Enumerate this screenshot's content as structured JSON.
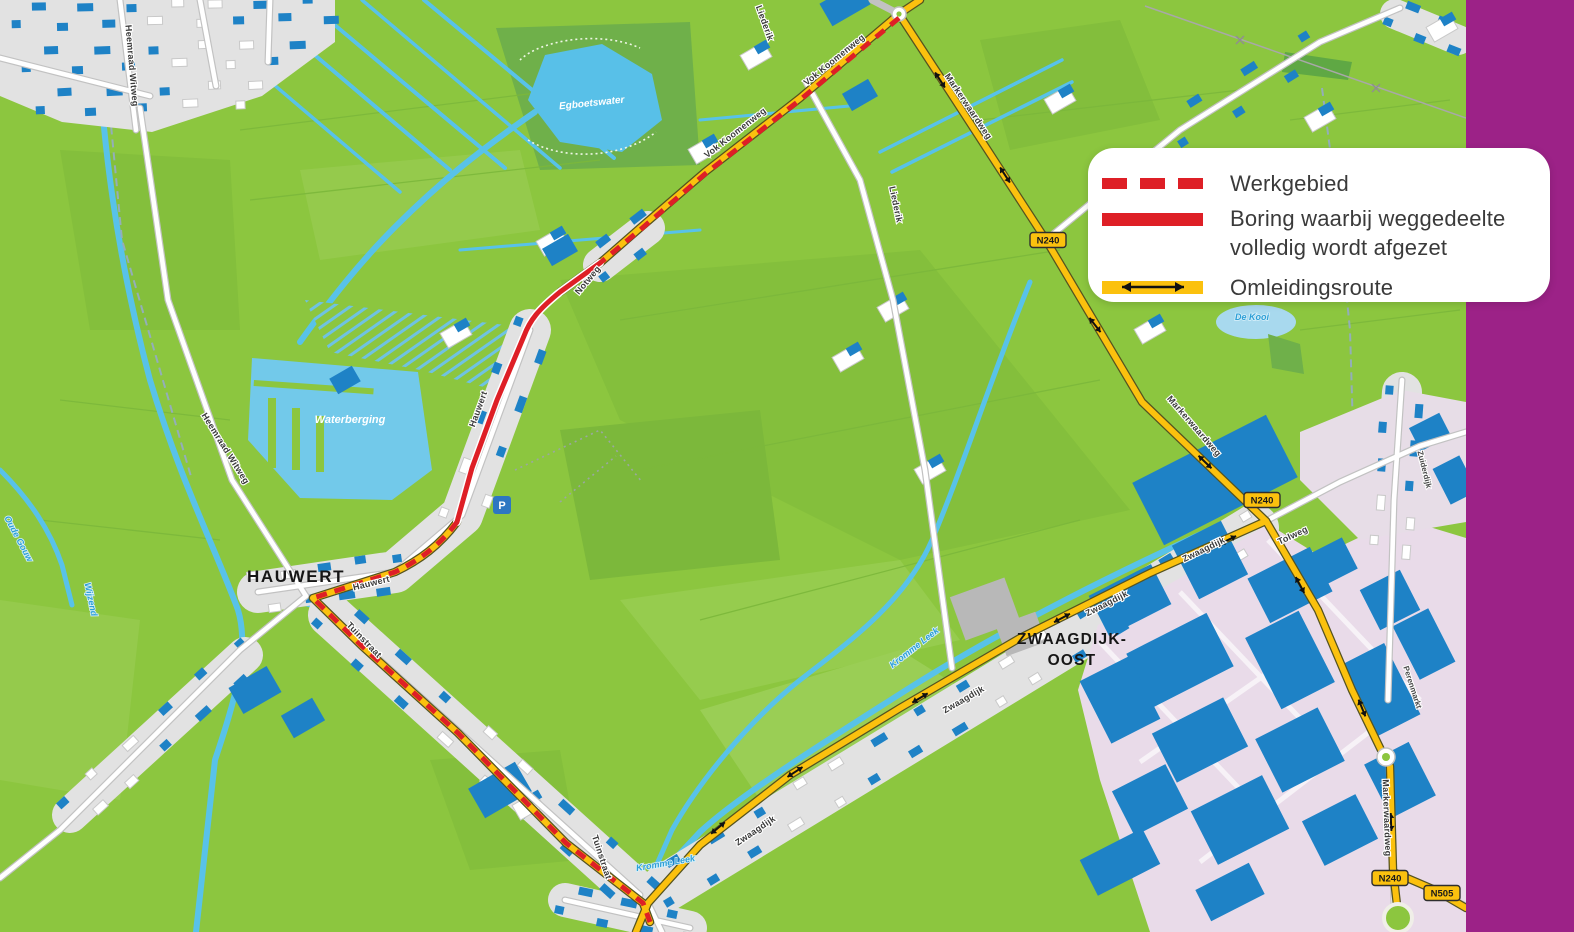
{
  "legend": {
    "items": [
      {
        "id": "werkgebied",
        "swatch": "red-dashed",
        "label": "Werkgebied"
      },
      {
        "id": "boring",
        "swatch": "red-solid",
        "label": "Boring waarbij weggedeelte volledig wordt afgezet",
        "label_line1": "Boring waarbij weggedeelte",
        "label_line2": "volledig wordt afgezet"
      },
      {
        "id": "omleidingsroute",
        "swatch": "yellow-arrow",
        "label": "Omleidingsroute"
      }
    ]
  },
  "places": {
    "hauwert": "HAUWERT",
    "zwaagdijk_oost_line1": "ZWAAGDIJK-",
    "zwaagdijk_oost_line2": "OOST"
  },
  "badges": {
    "n240": "N240",
    "n505": "N505"
  },
  "roads": {
    "vok_koomenweg": "Vok Koomenweg",
    "notweg": "Notweg",
    "hauwert_street": "Hauwert",
    "tuinstraat": "Tuinstraat",
    "zwaagdijk": "Zwaagdijk",
    "markerwaardweg": "Markerwaardweg",
    "liederik": "Liederik",
    "heemraad_witweg": "Heemraad Witweg",
    "tolweg": "Tolweg",
    "zuiderdijk": "Zuiderdijk",
    "perenmarkt": "Perenmarkt"
  },
  "water": {
    "kromme_leek": "Kromme Leek",
    "oude_gouw": "Oude Gouw",
    "wijzend": "Wijzend",
    "egboetswater": "Egboetswater",
    "waterberging": "Waterberging",
    "de_kooi": "De Kooi"
  },
  "icons": {
    "parking": "P"
  },
  "colors": {
    "map_green": "#8CC63F",
    "water_blue": "#58C2E9",
    "building_blue": "#1E82C6",
    "route_yellow": "#FBC10E",
    "route_red": "#DE1F26",
    "industrial_lavender": "#E9DBE9",
    "sidebar_purple": "#9C2287"
  }
}
